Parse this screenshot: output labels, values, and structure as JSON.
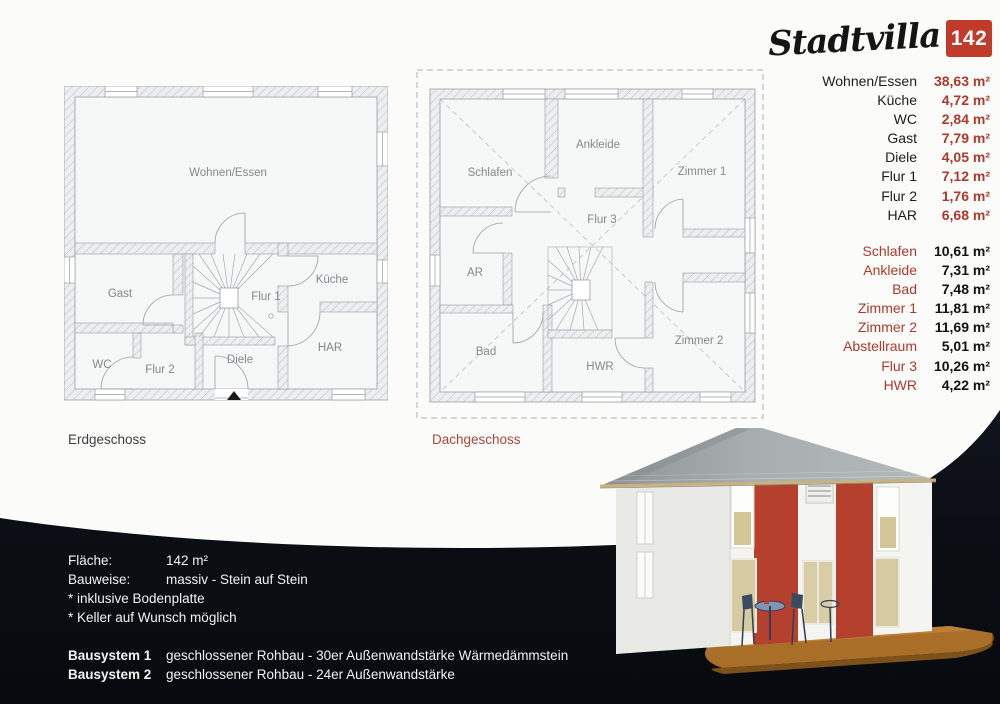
{
  "brand": {
    "name": "Stadtvilla",
    "badge": "142"
  },
  "captions": {
    "ground": "Erdgeschoss",
    "upper": "Dachgeschoss"
  },
  "rooms_ground": {
    "wohnen": "Wohnen/Essen",
    "gast": "Gast",
    "kueche": "Küche",
    "flur1": "Flur 1",
    "wc": "WC",
    "flur2": "Flur 2",
    "diele": "Diele",
    "har": "HAR"
  },
  "rooms_upper": {
    "schlafen": "Schlafen",
    "ankleide": "Ankleide",
    "zimmer1": "Zimmer 1",
    "flur3": "Flur 3",
    "ar": "AR",
    "bad": "Bad",
    "hwr": "HWR",
    "zimmer2": "Zimmer 2"
  },
  "table_ground": [
    {
      "label": "Wohnen/Essen",
      "value": "38,63 m²"
    },
    {
      "label": "Küche",
      "value": "4,72 m²"
    },
    {
      "label": "WC",
      "value": "2,84 m²"
    },
    {
      "label": "Gast",
      "value": "7,79 m²"
    },
    {
      "label": "Diele",
      "value": "4,05 m²"
    },
    {
      "label": "Flur 1",
      "value": "7,12 m²"
    },
    {
      "label": "Flur 2",
      "value": "1,76 m²"
    },
    {
      "label": "HAR",
      "value": "6,68 m²"
    }
  ],
  "table_upper": [
    {
      "label": "Schlafen",
      "value": "10,61 m²"
    },
    {
      "label": "Ankleide",
      "value": "7,31 m²"
    },
    {
      "label": "Bad",
      "value": "7,48 m²"
    },
    {
      "label": "Zimmer 1",
      "value": "11,81 m²"
    },
    {
      "label": "Zimmer 2",
      "value": "11,69 m²"
    },
    {
      "label": "Abstellraum",
      "value": "5,01 m²"
    },
    {
      "label": "Flur 3",
      "value": "10,26 m²"
    },
    {
      "label": "HWR",
      "value": "4,22 m²"
    }
  ],
  "specs": {
    "rows": [
      {
        "label": "Fläche:",
        "value": "142 m²"
      },
      {
        "label": "Bauweise:",
        "value": "massiv - Stein auf Stein"
      }
    ],
    "notes": [
      "* inklusive Bodenplatte",
      "* Keller auf Wunsch möglich"
    ],
    "systems": [
      {
        "label": "Bausystem 1",
        "value": "geschlossener Rohbau - 30er Außenwandstärke Wärmedämmstein"
      },
      {
        "label": "Bausystem 2",
        "value": "geschlossener Rohbau - 24er Außenwandstärke"
      }
    ]
  },
  "colors": {
    "accent_red": "#ac3a2e",
    "badge_red": "#c13b2b",
    "dark_background": "#0b0e14",
    "roof_gray": "#9aa0a2",
    "terrace_brown": "#a96f28",
    "facade_stripe_red": "#b5402e"
  }
}
